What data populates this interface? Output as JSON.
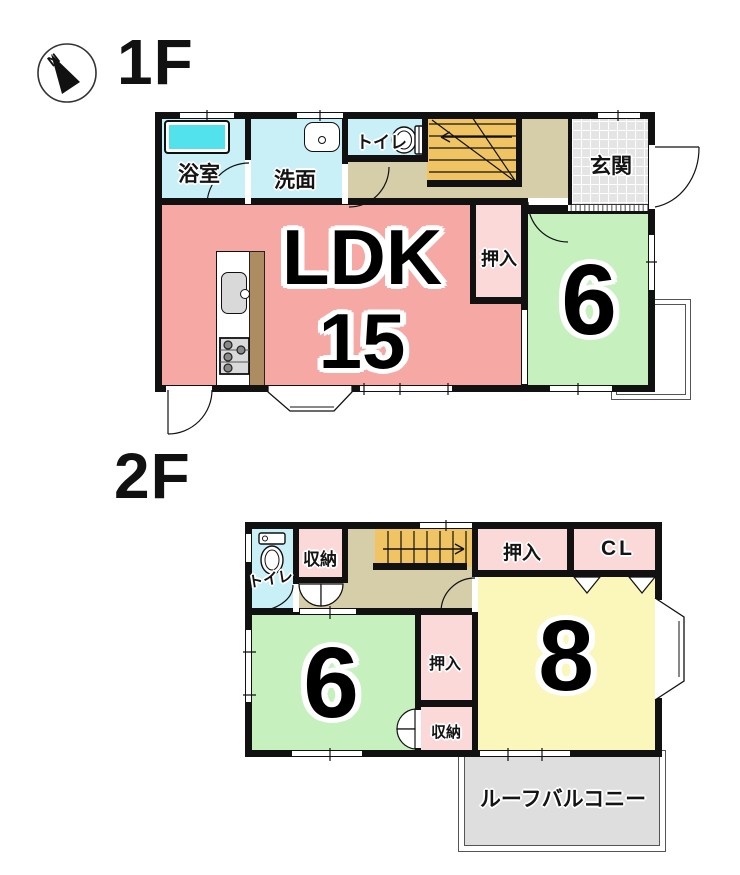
{
  "compass": {
    "north_label": "N"
  },
  "floor1": {
    "title": "1F",
    "bath": "浴室",
    "washroom": "洗面",
    "toilet": "トイレ",
    "entrance": "玄関",
    "ldk_name": "LDK",
    "ldk_tatami": "15",
    "closet": "押入",
    "room6_tatami": "6"
  },
  "floor2": {
    "title": "2F",
    "toilet": "トイレ",
    "storage_upper": "収納",
    "closet_upper": "押入",
    "closet_cl": "CL",
    "room6_tatami": "6",
    "closet_middle": "押入",
    "storage_lower": "収納",
    "room8_tatami": "8",
    "roof_balcony": "ルーフバルコニー"
  },
  "colors": {
    "wall": "#111111",
    "ldk_pink": "#F5A8A4",
    "closet_pink": "#FBD9D8",
    "room_green": "#C6F1BF",
    "room_yellow": "#FBF6BA",
    "wet_area_cyan": "#C9EFF7",
    "bathtub_cyan": "#52E2EE",
    "stairs_orange": "#F1C463",
    "hallway_tan": "#D6CDA9",
    "entrance_gray": "#E4E4E4",
    "roof_balcony_gray": "#DEDEDE"
  }
}
